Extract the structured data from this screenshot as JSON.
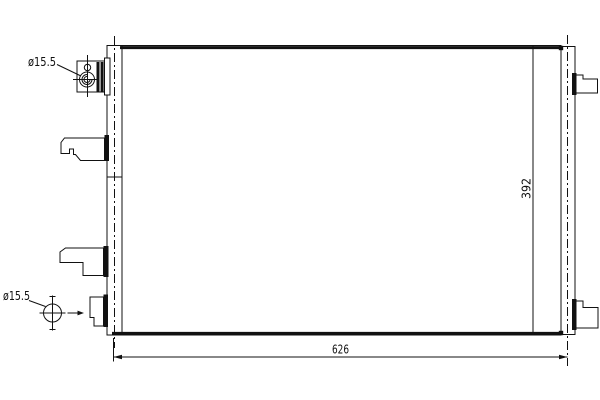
{
  "drawing": {
    "labels": {
      "port_top": "ø15.5",
      "port_bottom": "ø15.5",
      "width_dim": "626",
      "height_dim": "392"
    },
    "colors": {
      "line": "#111111",
      "background": "#ffffff"
    },
    "icons": {
      "flow_arrow": "right-arrow",
      "diameter_symbol": "ø"
    }
  }
}
